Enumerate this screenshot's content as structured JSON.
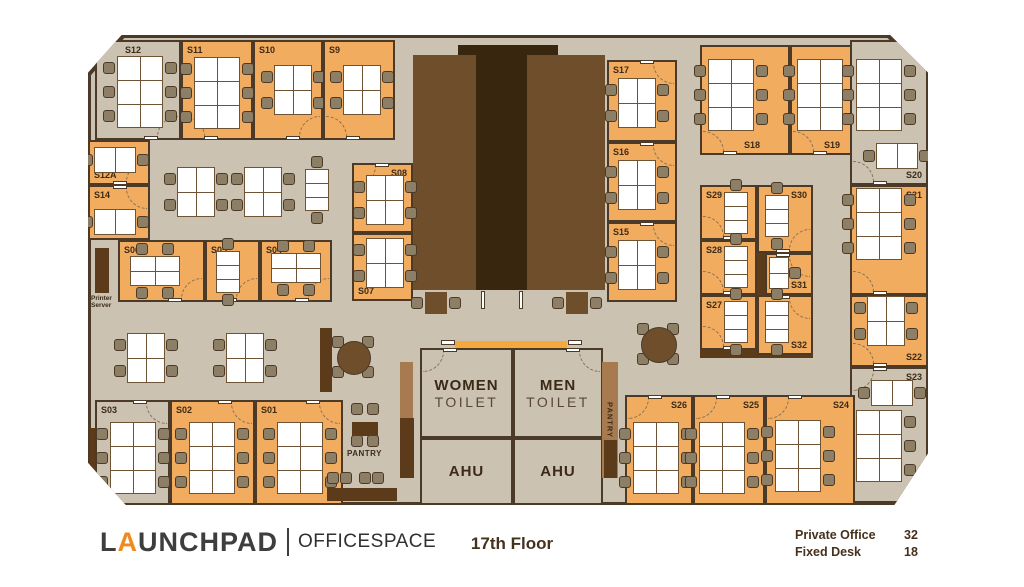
{
  "meta": {
    "floor_label": "17th Floor"
  },
  "brand": {
    "logo_parts": [
      {
        "t": "L",
        "c": "dark"
      },
      {
        "t": "A",
        "c": "accent"
      },
      {
        "t": "UNCHPAD",
        "c": "dark"
      }
    ],
    "suffix": "OFFICESPACE"
  },
  "legend": {
    "stats": [
      {
        "label": "Private Office",
        "value": "32"
      },
      {
        "label": "Fixed Desk",
        "value": "18"
      }
    ]
  },
  "colors": {
    "wall": "#4A3A27",
    "floor": "#CBC2B2",
    "office": "#F2AC60",
    "accent": "#F08A1D",
    "cabinet": "#5C3B1B",
    "core": "#6F4E2C",
    "core_dark": "#38260F",
    "pantry_strip": "#A87A4F",
    "chair": "#8D7E66",
    "text": "#3B2A16",
    "entrance": "#F5A93C"
  },
  "floorplan": {
    "core": [
      {
        "x": 458,
        "y": 45,
        "w": 100,
        "h": 18,
        "c": "core_dark"
      },
      {
        "x": 476,
        "y": 45,
        "w": 51,
        "h": 245,
        "c": "core_dark"
      },
      {
        "x": 413,
        "y": 55,
        "w": 63,
        "h": 235,
        "c": "core"
      },
      {
        "x": 527,
        "y": 55,
        "w": 78,
        "h": 235,
        "c": "core"
      }
    ],
    "rooms": [
      {
        "id": "S12",
        "x": 95,
        "y": 40,
        "w": 86,
        "h": 100,
        "f": "g",
        "lp": "tl2",
        "door": "br",
        "tables": [
          [
            "t6v",
            140,
            92
          ]
        ]
      },
      {
        "id": "S11",
        "x": 181,
        "y": 40,
        "w": 72,
        "h": 100,
        "f": "o",
        "lp": "tl",
        "door": "bl",
        "tables": [
          [
            "t6v",
            217,
            93
          ]
        ]
      },
      {
        "id": "S10",
        "x": 253,
        "y": 40,
        "w": 70,
        "h": 100,
        "f": "o",
        "lp": "tl",
        "door": "br",
        "tables": [
          [
            "t4v",
            293,
            90
          ]
        ]
      },
      {
        "id": "S9",
        "x": 323,
        "y": 40,
        "w": 72,
        "h": 100,
        "f": "o",
        "lp": "tl",
        "door": "bl",
        "tables": [
          [
            "t4v",
            362,
            90
          ]
        ]
      },
      {
        "id": "S12A",
        "x": 88,
        "y": 140,
        "w": 62,
        "h": 45,
        "f": "o",
        "lp": "bl",
        "door": "br",
        "tables": [
          [
            "t2h",
            115,
            160
          ]
        ]
      },
      {
        "id": "S14",
        "x": 88,
        "y": 185,
        "w": 62,
        "h": 55,
        "f": "o",
        "lp": "tl",
        "door": "tr",
        "tables": [
          [
            "t2h",
            115,
            222
          ]
        ]
      },
      {
        "id": "S06",
        "x": 118,
        "y": 240,
        "w": 87,
        "h": 62,
        "f": "o",
        "lp": "tl",
        "door": "br",
        "tables": [
          [
            "t4h",
            155,
            271
          ]
        ]
      },
      {
        "id": "S05",
        "x": 205,
        "y": 240,
        "w": 55,
        "h": 62,
        "f": "o",
        "lp": "tl",
        "door": "br",
        "tables": [
          [
            "t2v",
            228,
            272
          ]
        ]
      },
      {
        "id": "S04",
        "x": 260,
        "y": 240,
        "w": 72,
        "h": 62,
        "f": "o",
        "lp": "tl",
        "door": "br",
        "tables": [
          [
            "t4h",
            296,
            268
          ]
        ]
      },
      {
        "id": "S08",
        "x": 352,
        "y": 163,
        "w": 61,
        "h": 70,
        "f": "o",
        "lp": "tr",
        "door": "tl",
        "tables": [
          [
            "t4v",
            385,
            200
          ]
        ]
      },
      {
        "id": "S07",
        "x": 352,
        "y": 233,
        "w": 61,
        "h": 68,
        "f": "o",
        "lp": "bl",
        "door": "",
        "tables": [
          [
            "t4v",
            385,
            263
          ]
        ]
      },
      {
        "id": "S17",
        "x": 607,
        "y": 60,
        "w": 70,
        "h": 82,
        "f": "o",
        "lp": "tl",
        "door": "tr",
        "tables": [
          [
            "t4v",
            637,
            103
          ]
        ]
      },
      {
        "id": "S16",
        "x": 607,
        "y": 142,
        "w": 70,
        "h": 80,
        "f": "o",
        "lp": "tl",
        "door": "tr",
        "tables": [
          [
            "t4v",
            637,
            185
          ]
        ]
      },
      {
        "id": "S15",
        "x": 607,
        "y": 222,
        "w": 70,
        "h": 80,
        "f": "o",
        "lp": "tl",
        "door": "tr",
        "tables": [
          [
            "t4v",
            637,
            265
          ]
        ]
      },
      {
        "id": "S18",
        "x": 700,
        "y": 45,
        "w": 90,
        "h": 110,
        "f": "o",
        "lp": "bc",
        "door": "bl",
        "tables": [
          [
            "t6v",
            731,
            95
          ]
        ]
      },
      {
        "id": "S19",
        "x": 790,
        "y": 45,
        "w": 80,
        "h": 110,
        "f": "o",
        "lp": "bc",
        "door": "bl",
        "tables": [
          [
            "t6v",
            820,
            95
          ]
        ]
      },
      {
        "id": "S20",
        "x": 850,
        "y": 40,
        "w": 78,
        "h": 145,
        "f": "g",
        "lp": "br",
        "door": "bl",
        "tables": [
          [
            "t6v",
            879,
            95
          ],
          [
            "t2h",
            897,
            156
          ]
        ]
      },
      {
        "id": "S21",
        "x": 850,
        "y": 185,
        "w": 78,
        "h": 110,
        "f": "o",
        "lp": "tr",
        "door": "bl",
        "tables": [
          [
            "t6v",
            879,
            224
          ]
        ]
      },
      {
        "id": "S22",
        "x": 850,
        "y": 295,
        "w": 78,
        "h": 72,
        "f": "o",
        "lp": "br",
        "door": "bl",
        "tables": [
          [
            "t4v",
            886,
            321
          ]
        ]
      },
      {
        "id": "S23",
        "x": 850,
        "y": 367,
        "w": 78,
        "h": 136,
        "f": "g",
        "lp": "tr",
        "door": "tl",
        "tables": [
          [
            "t2h",
            892,
            393
          ],
          [
            "t6v",
            879,
            446
          ]
        ]
      },
      {
        "id": "S29",
        "x": 700,
        "y": 185,
        "w": 57,
        "h": 55,
        "f": "o",
        "lp": "tl",
        "door": "bl",
        "tables": [
          [
            "t2v",
            736,
            213
          ]
        ]
      },
      {
        "id": "S30",
        "x": 757,
        "y": 185,
        "w": 56,
        "h": 68,
        "f": "o",
        "lp": "tr",
        "door": "br",
        "tables": [
          [
            "t2v",
            777,
            216
          ]
        ]
      },
      {
        "id": "S28",
        "x": 700,
        "y": 240,
        "w": 57,
        "h": 55,
        "f": "o",
        "lp": "tl",
        "door": "bl",
        "tables": [
          [
            "t2v",
            736,
            267
          ]
        ]
      },
      {
        "id": "S31",
        "x": 765,
        "y": 253,
        "w": 48,
        "h": 42,
        "f": "o",
        "lp": "br",
        "door": "tr",
        "tables": [
          [
            "t1",
            779,
            273
          ]
        ]
      },
      {
        "id": "S27",
        "x": 700,
        "y": 295,
        "w": 57,
        "h": 55,
        "f": "o",
        "lp": "tl",
        "door": "bl",
        "tables": [
          [
            "t2v",
            736,
            322
          ]
        ]
      },
      {
        "id": "S32",
        "x": 757,
        "y": 295,
        "w": 56,
        "h": 60,
        "f": "o",
        "lp": "br",
        "door": "tr",
        "tables": [
          [
            "t2v",
            777,
            322
          ]
        ]
      },
      {
        "id": "S03",
        "x": 95,
        "y": 400,
        "w": 75,
        "h": 105,
        "f": "g",
        "lp": "tl",
        "door": "tr",
        "tables": [
          [
            "t6v",
            133,
            458
          ]
        ]
      },
      {
        "id": "S02",
        "x": 170,
        "y": 400,
        "w": 85,
        "h": 105,
        "f": "o",
        "lp": "tl",
        "door": "tr",
        "tables": [
          [
            "t6v",
            212,
            458
          ]
        ]
      },
      {
        "id": "S01",
        "x": 255,
        "y": 400,
        "w": 88,
        "h": 105,
        "f": "o",
        "lp": "tl",
        "door": "tr",
        "tables": [
          [
            "t6v",
            300,
            458
          ]
        ]
      },
      {
        "id": "S26",
        "x": 625,
        "y": 395,
        "w": 68,
        "h": 110,
        "f": "o",
        "lp": "tr",
        "door": "tl",
        "tables": [
          [
            "t6v",
            656,
            458
          ]
        ]
      },
      {
        "id": "S25",
        "x": 693,
        "y": 395,
        "w": 72,
        "h": 110,
        "f": "o",
        "lp": "tr",
        "door": "tl",
        "tables": [
          [
            "t6v",
            722,
            458
          ]
        ]
      },
      {
        "id": "S24",
        "x": 765,
        "y": 395,
        "w": 90,
        "h": 110,
        "f": "o",
        "lp": "tr",
        "door": "tl",
        "tables": [
          [
            "t6v",
            798,
            456
          ]
        ]
      }
    ],
    "zones": [
      {
        "id": "women-toilet",
        "x": 420,
        "y": 348,
        "w": 93,
        "h": 90,
        "door": "tl",
        "lines": [
          {
            "text": "WOMEN",
            "style": "big"
          },
          {
            "text": "TOILET",
            "style": "sub"
          }
        ]
      },
      {
        "id": "men-toilet",
        "x": 513,
        "y": 348,
        "w": 90,
        "h": 90,
        "door": "tr",
        "lines": [
          {
            "text": "MEN",
            "style": "big"
          },
          {
            "text": "TOILET",
            "style": "sub"
          }
        ]
      },
      {
        "id": "ahu-left",
        "x": 420,
        "y": 438,
        "w": 93,
        "h": 67,
        "door": "",
        "lines": [
          {
            "text": "AHU",
            "style": "big"
          }
        ]
      },
      {
        "id": "ahu-right",
        "x": 513,
        "y": 438,
        "w": 90,
        "h": 67,
        "door": "",
        "lines": [
          {
            "text": "AHU",
            "style": "big"
          }
        ]
      }
    ],
    "strips": [
      {
        "x": 602,
        "y": 362,
        "w": 16,
        "h": 116,
        "c": "pantry_strip",
        "vtext": "PANTRY"
      },
      {
        "x": 400,
        "y": 362,
        "w": 13,
        "h": 56,
        "c": "pantry_strip",
        "vtext": ""
      },
      {
        "x": 400,
        "y": 418,
        "w": 14,
        "h": 60,
        "c": "cabinet",
        "vtext": ""
      },
      {
        "x": 604,
        "y": 440,
        "w": 13,
        "h": 38,
        "c": "cabinet",
        "vtext": ""
      }
    ],
    "cabinets": [
      [
        95,
        73,
        12,
        40
      ],
      [
        255,
        70,
        11,
        38
      ],
      [
        750,
        77,
        12,
        44
      ],
      [
        908,
        77,
        14,
        40
      ],
      [
        908,
        253,
        13,
        38
      ],
      [
        908,
        435,
        13,
        40
      ],
      [
        750,
        433,
        12,
        42
      ],
      [
        253,
        428,
        13,
        44
      ],
      [
        90,
        428,
        12,
        44
      ],
      [
        95,
        248,
        14,
        45
      ],
      [
        252,
        248,
        13,
        44
      ],
      [
        320,
        328,
        12,
        64
      ],
      [
        700,
        350,
        113,
        8
      ],
      [
        757,
        253,
        8,
        42
      ]
    ],
    "open_tables": [
      [
        "t4v",
        196,
        192
      ],
      [
        "t4v",
        263,
        192
      ],
      [
        "t2v",
        317,
        190
      ],
      [
        "t4v",
        146,
        358
      ],
      [
        "t4v",
        245,
        358
      ]
    ],
    "round_tables": [
      [
        353,
        357,
        16
      ],
      [
        658,
        344,
        17
      ]
    ],
    "bench_sets": [
      [
        436,
        303
      ],
      [
        577,
        303
      ]
    ],
    "pantry": {
      "table": {
        "x": 352,
        "y": 422,
        "w": 26,
        "h": 14
      },
      "table_chairs": [
        [
          357,
          409
        ],
        [
          373,
          409
        ],
        [
          357,
          441
        ],
        [
          373,
          441
        ]
      ],
      "label": {
        "text": "PANTRY",
        "x": 347,
        "y": 449
      },
      "counter": {
        "x": 327,
        "y": 488,
        "w": 70,
        "h": 13
      },
      "stools": [
        [
          333,
          478
        ],
        [
          346,
          478
        ],
        [
          365,
          478
        ],
        [
          378,
          478
        ]
      ]
    },
    "entrance": {
      "x": 455,
      "y": 341,
      "w": 112,
      "h": 7
    },
    "slits": [
      [
        481,
        291,
        4,
        18
      ],
      [
        519,
        291,
        4,
        18
      ],
      [
        441,
        340,
        14,
        5
      ],
      [
        568,
        340,
        14,
        5
      ]
    ],
    "annotations": [
      {
        "line1": "Printer",
        "line2": "Server",
        "x": 91,
        "y": 295
      }
    ]
  }
}
